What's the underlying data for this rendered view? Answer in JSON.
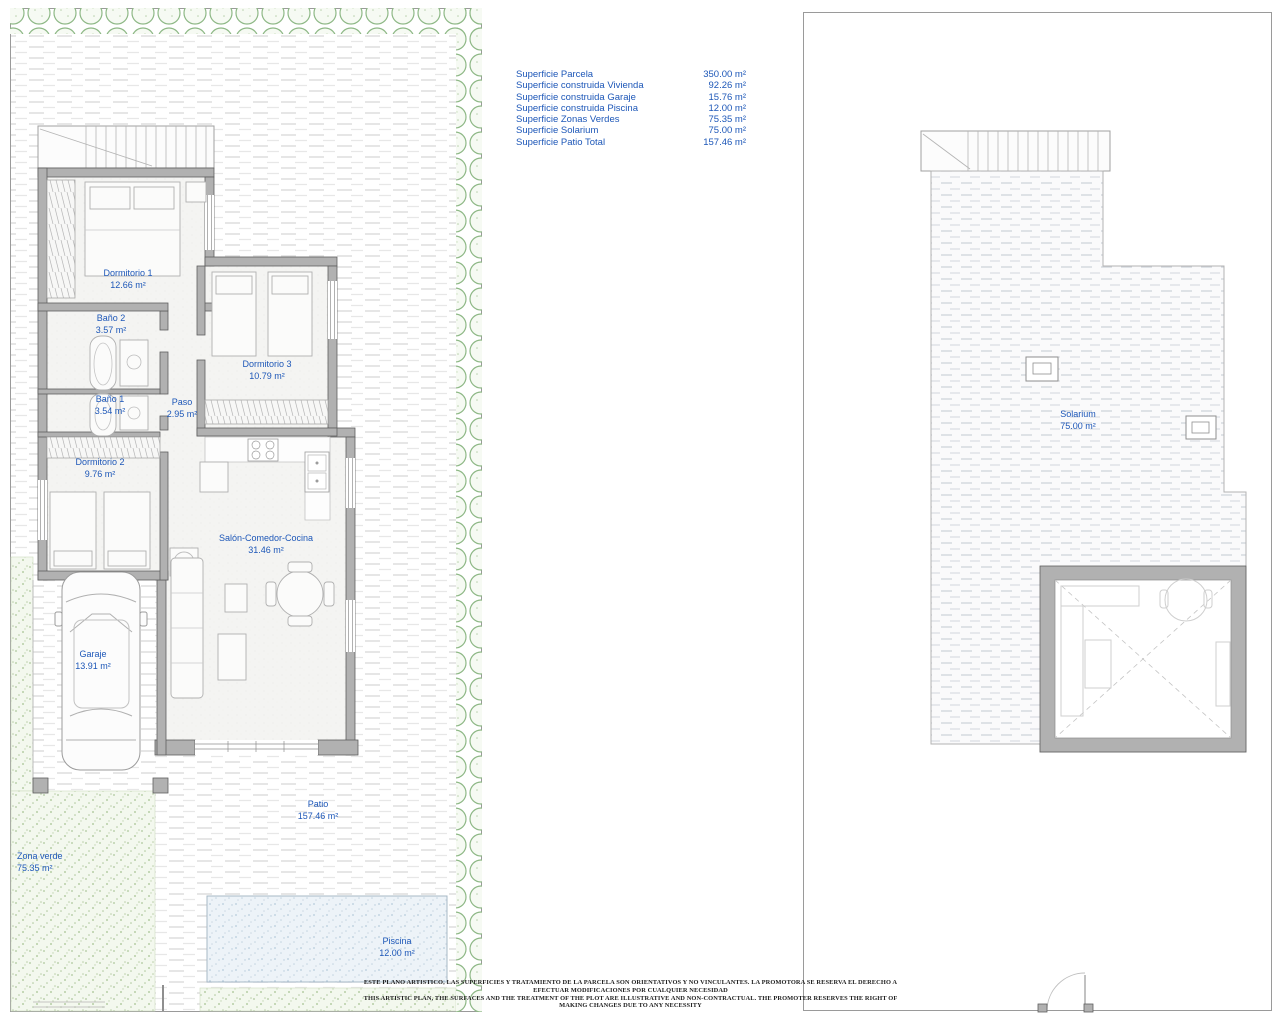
{
  "summary": {
    "rows": [
      {
        "label": "Superficie Parcela",
        "value": "350.00 m²"
      },
      {
        "label": "Superficie construida Vivienda",
        "value": "92.26 m²"
      },
      {
        "label": "Superficie construida Garaje",
        "value": "15.76 m²"
      },
      {
        "label": "Superficie construida Piscina",
        "value": "12.00 m²"
      },
      {
        "label": "Superficie Zonas Verdes",
        "value": "75.35 m²"
      },
      {
        "label": "Superficie Solarium",
        "value": "75.00 m²"
      },
      {
        "label": "Superficie Patio Total",
        "value": "157.46 m²"
      }
    ]
  },
  "ground_floor": {
    "rooms": {
      "dormitorio1": {
        "name": "Dormitorio 1",
        "area": "12.66 m²"
      },
      "bano2": {
        "name": "Baño 2",
        "area": "3.57 m²"
      },
      "dormitorio3": {
        "name": "Dormitorio 3",
        "area": "10.79 m²"
      },
      "bano1": {
        "name": "Baño 1",
        "area": "3.54 m²"
      },
      "paso": {
        "name": "Paso",
        "area": "2.95 m²"
      },
      "dormitorio2": {
        "name": "Dormitorio 2",
        "area": "9.76 m²"
      },
      "salon": {
        "name": "Salón-Comedor-Cocina",
        "area": "31.46 m²"
      },
      "garaje": {
        "name": "Garaje",
        "area": "13.91 m²"
      },
      "patio": {
        "name": "Patio",
        "area": "157.46 m²"
      },
      "zona_verde": {
        "name": "Zona verde",
        "area": "75.35 m²"
      },
      "piscina": {
        "name": "Piscina",
        "area": "12.00 m²"
      }
    }
  },
  "roof_floor": {
    "rooms": {
      "solarium": {
        "name": "Solarium",
        "area": "75.00 m²"
      }
    }
  },
  "disclaimer": {
    "line1": "ESTE PLANO ARTISTICO, LAS SUPERFICIES Y TRATAMIENTO DE LA PARCELA SON ORIENTATIVOS Y NO VINCULANTES. LA PROMOTORA SE RESERVA EL DERECHO A EFECTUAR MODIFICACIONES POR CUALQUIER NECESIDAD",
    "line2": "THIS ARTISTIC PLAN, THE SURFACES AND THE TREATMENT OF THE PLOT ARE ILLUSTRATIVE AND NON-CONTRACTUAL. THE PROMOTER RESERVES THE RIGHT OF MAKING CHANGES DUE TO ANY NECESSITY"
  },
  "colors": {
    "label_blue": "#1d57b8",
    "wall_gray": "#b1b1b1",
    "tree_green": "#8eb886",
    "zona_verde_fill": "#f3f8ee",
    "pool_fill": "#edf3f8"
  }
}
